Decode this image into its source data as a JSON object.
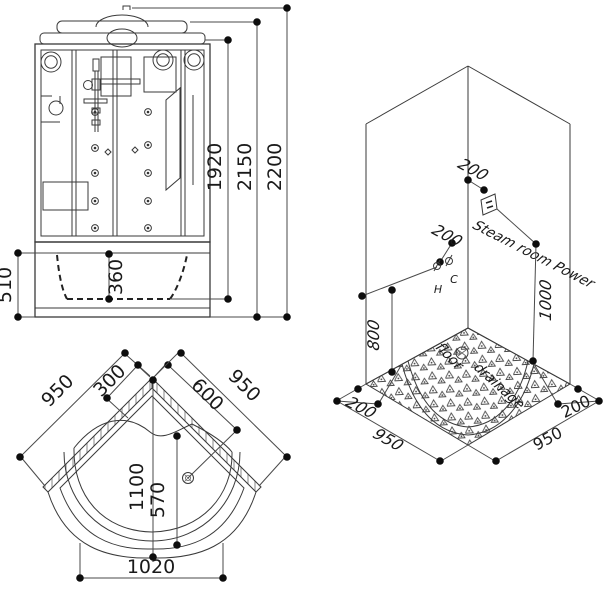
{
  "drawing": {
    "front_view": {
      "dims": {
        "body_height": "1920",
        "cap_height": "2150",
        "total_height": "2200",
        "tub_height": "510",
        "tub_depth": "360"
      }
    },
    "iso_view": {
      "dims": {
        "outlet_offset": "200",
        "hc_offset": "200",
        "hc_height": "800",
        "power_height": "1000",
        "left_gap": "200",
        "left_width": "950",
        "right_width": "950",
        "right_gap": "200"
      },
      "labels": {
        "steam_power": "Steam room Power",
        "floor_word": "floor",
        "drainage_word": "drainage",
        "hot": "H",
        "cold": "C"
      }
    },
    "plan_view": {
      "dims": {
        "left_wall": "950",
        "seat_offset": "300",
        "drain_offset": "600",
        "right_wall": "950",
        "diagonal": "1100",
        "inner_depth": "570",
        "front_width": "1020"
      }
    },
    "colors": {
      "line": "#3a3a3a",
      "text": "#1a1a1a",
      "hatch": "#999999",
      "background": "#ffffff"
    }
  }
}
